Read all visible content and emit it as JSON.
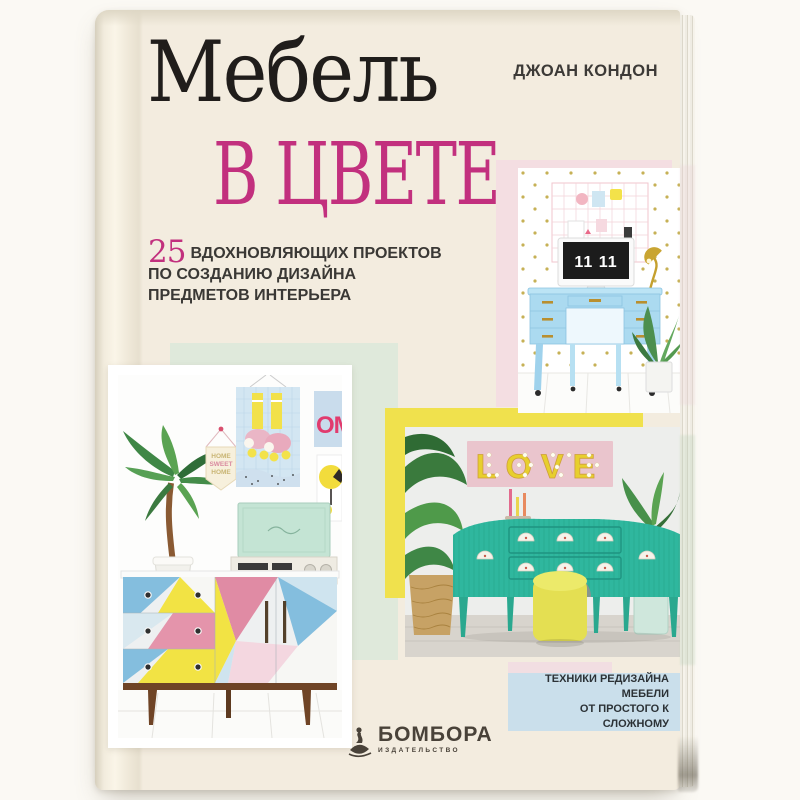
{
  "book": {
    "author": "ДЖОАН КОНДОН",
    "title": {
      "main": "Мебель",
      "accent": "в цвете"
    },
    "subtitle": {
      "number": "25",
      "line1": "ВДОХНОВЛЯЮЩИХ ПРОЕКТОВ",
      "line2": "ПО СОЗДАНИЮ ДИЗАЙНА",
      "line3": "ПРЕДМЕТОВ ИНТЕРЬЕРА"
    },
    "badge": {
      "line1": "ТЕХНИКИ РЕДИЗАЙНА МЕБЕЛИ",
      "line2": "ОТ ПРОСТОГО К СЛОЖНОМУ"
    },
    "publisher": {
      "name": "БОМБОРА",
      "tagline": "ИЗДАТЕЛЬСТВО"
    },
    "photos": {
      "desk": {
        "clock": "11 11"
      },
      "gallery": {
        "poster_om": "OM",
        "pennant": {
          "line1": "HOME",
          "line2": "SWEET",
          "line3": "HOME"
        }
      },
      "love": {
        "sign": "LOVE"
      }
    },
    "colors": {
      "cover": "#f3ecdf",
      "accent_magenta": "#c2307e",
      "panel_pink": "#f4dee2",
      "panel_mint": "#dfe9db",
      "panel_yellow": "#f0e14d",
      "badge_blue": "#cadfeb",
      "desk_blue": "#abdaf0",
      "sideboard_teal": "#2fb79e",
      "text_dark": "#3a3835"
    }
  }
}
